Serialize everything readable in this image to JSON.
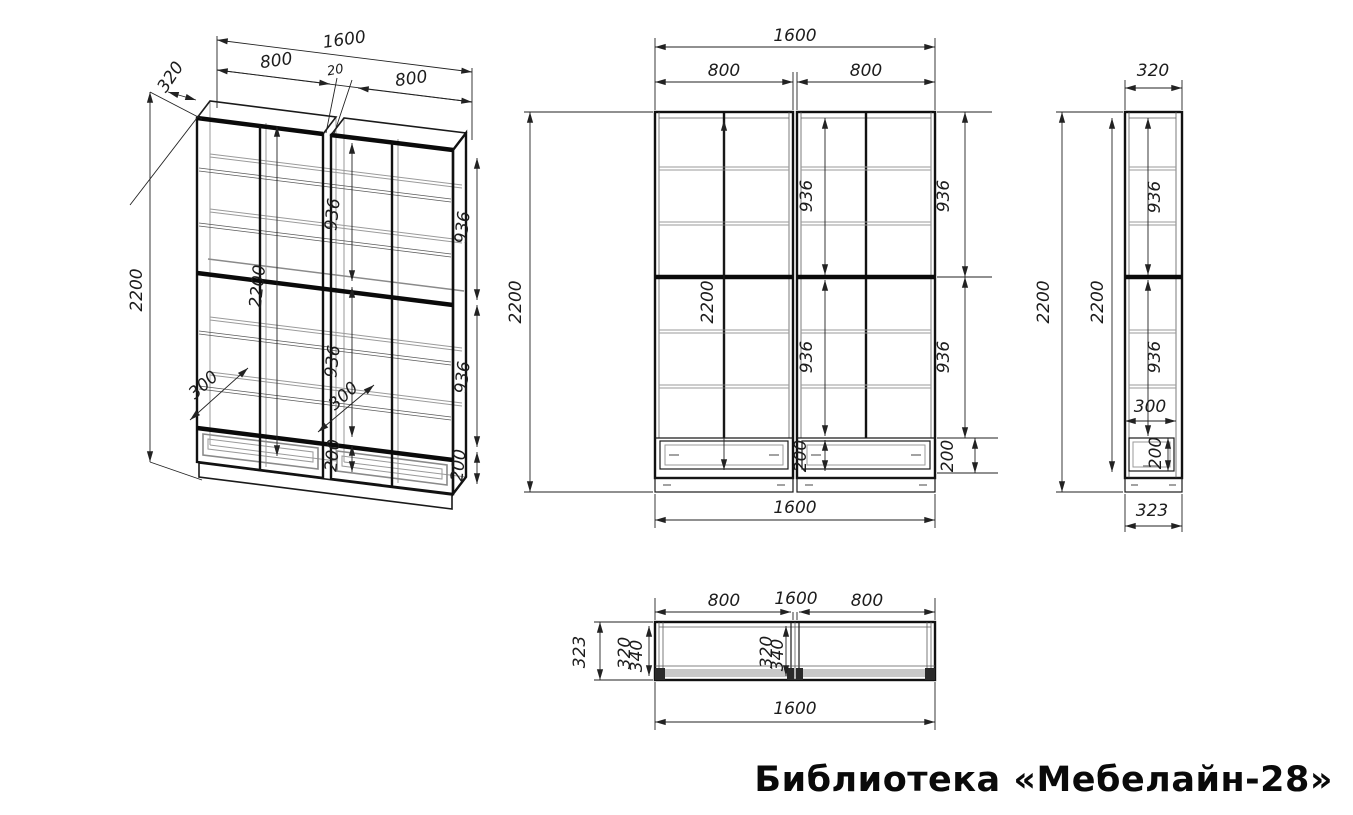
{
  "title": "Библиотека «Мебелайн-28»",
  "colors": {
    "line": "#1a1a1a",
    "gray": "#9a9a9a",
    "background": "#ffffff"
  },
  "dims": {
    "iso": {
      "total_width": "1600",
      "left_width": "800",
      "gap": "20",
      "right_width": "800",
      "depth": "320",
      "height_ext": "2200",
      "height_int": "2200",
      "upper_936_a": "936",
      "upper_936_b": "936",
      "lower_936_a": "936",
      "lower_936_b": "936",
      "shelf_depth_a": "300",
      "shelf_depth_b": "300",
      "drawer_h_a": "200",
      "drawer_h_b": "200"
    },
    "front": {
      "total_width_top": "1600",
      "left_width": "800",
      "right_width": "800",
      "height_ext": "2200",
      "height_int": "2200",
      "upper_int": "936",
      "lower_int": "936",
      "drawer_int": "200",
      "upper_ext": "936",
      "lower_ext": "936",
      "drawer_ext": "200",
      "total_width_bottom": "1600"
    },
    "side": {
      "depth_top": "320",
      "height_ext": "2200",
      "height_int": "2200",
      "upper": "936",
      "lower": "936",
      "shelf_depth": "300",
      "drawer_h": "200",
      "depth_bottom": "323"
    },
    "plan": {
      "left_width": "800",
      "mid_width": "1600",
      "right_width": "800",
      "depth_ext": "323",
      "depth_int_a": "320",
      "depth_int_b": "340",
      "depth_mid_a": "320",
      "depth_mid_b": "340",
      "total_width": "1600"
    }
  }
}
